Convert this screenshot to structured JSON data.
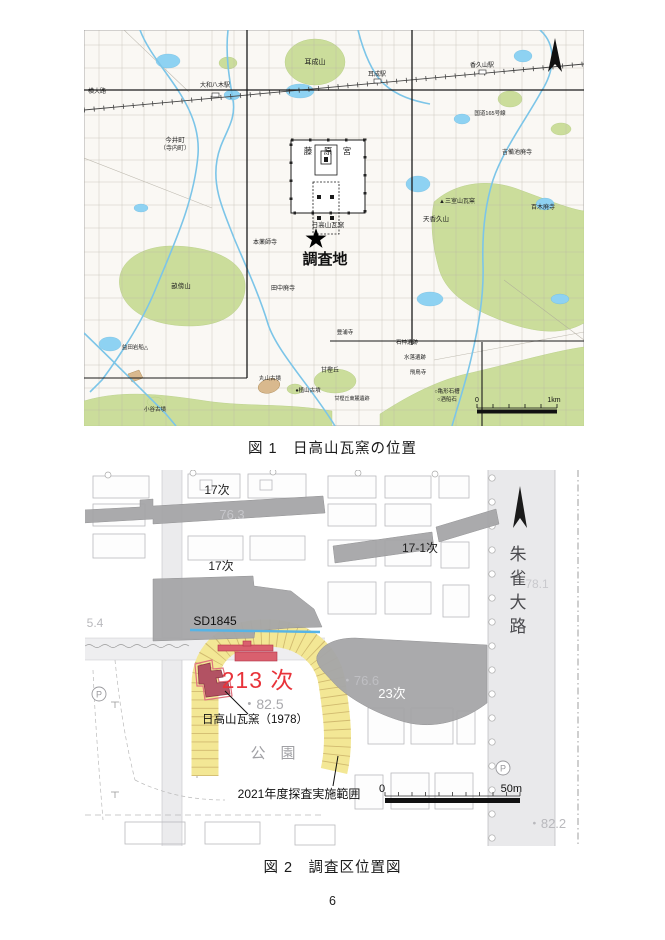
{
  "page": {
    "number": "6"
  },
  "figure1": {
    "caption": "図 1　日高山瓦窯の位置",
    "scale": {
      "start": "0",
      "end": "1km"
    },
    "labels": {
      "yokooji": "横大路",
      "yamato_yagi_station": "大和八木駅",
      "imaicho_line1": "今井町",
      "imaicho_line2": "（寺内町）",
      "miminashiyama": "耳成山",
      "miminashi_station": "耳成駅",
      "kaguyama_station": "香久山駅",
      "route165": "国道165号線",
      "kibiike_haiji": "吉備池廃寺",
      "momoki_haiji": "百木廃寺",
      "mimuroyama_gayo": "▲三室山瓦窯",
      "palace_char1": "藤",
      "palace_char2": "原",
      "palace_char3": "宮",
      "hidakayama_gayo": "日高山瓦窯",
      "survey_site": "調査地",
      "moto_yakushiji": "本薬師寺",
      "tanaka_haiji": "田中廃寺",
      "amakaguyama": "天香久山",
      "unebiyama": "畝傍山",
      "masuda_iwafune": "益田岩船△",
      "kotani_kofun": "小谷古墳",
      "maruyama_kofun": "丸山古墳",
      "ueyama_kofun": "●植山古墳",
      "amakashi_hill": "甘樫丘",
      "amakashi_toroku": "甘樫丘東麓遺跡",
      "toyura_dera": "豊浦寺",
      "ishigami_iseki": "石神遺跡",
      "mizuochi_iseki": "水落遺跡",
      "asukadera": "飛鳥寺",
      "kamegata_sekizo": "○亀形石槽",
      "sakafuneishi": "○酒船石"
    },
    "colors": {
      "hill_green": "#cbdd9b",
      "water_blue": "#8ed2f2"
    }
  },
  "figure2": {
    "caption": "図 2　調査区位置図",
    "scale": {
      "start": "0",
      "end": "50m"
    },
    "labels": {
      "trench17_north": "17次",
      "trench17_south": "17次",
      "trench17_1": "17-1次",
      "sd1845": "SD1845",
      "trench213": "213 次",
      "hidakayama_1978": "日高山瓦窯（1978）",
      "trench23": "23次",
      "survey2021": "2021年度探査実施範囲",
      "park": "公　園",
      "parking": "P",
      "suzaku_char1": "朱",
      "suzaku_char2": "雀",
      "suzaku_char3": "大",
      "suzaku_char4": "路",
      "elev_763": "76.3",
      "elev_766": "・76.6",
      "elev_825": "・82.5",
      "elev_781": "78.1",
      "elev_822": "・82.2",
      "elev_54": "5.4"
    },
    "colors": {
      "survey_yellow": "#f3e795",
      "excavation_gray": "#a6a6a8",
      "kiln_fill": "#b25263",
      "trench_red": "#d9606e",
      "label_red": "#e8333a",
      "ditch_blue": "#56b4e6"
    }
  }
}
